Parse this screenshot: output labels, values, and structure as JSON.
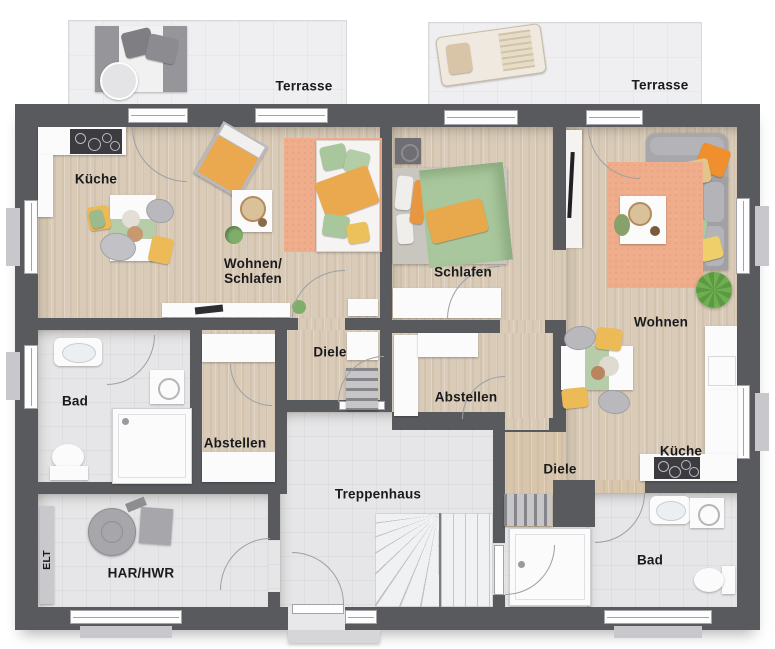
{
  "floorplan": {
    "type": "apartment-floor-plan",
    "rooms": {
      "terrace_left": {
        "label": "Terrasse"
      },
      "terrace_right": {
        "label": "Terrasse"
      },
      "kueche_left": {
        "label": "Küche"
      },
      "wohnen_schlafen": {
        "label_line1": "Wohnen/",
        "label_line2": "Schlafen"
      },
      "schlafen_right": {
        "label": "Schlafen"
      },
      "wohnen_right": {
        "label": "Wohnen"
      },
      "diele_left": {
        "label": "Diele"
      },
      "bad_left": {
        "label": "Bad"
      },
      "abstellen_right": {
        "label": "Abstellen"
      },
      "abstellen_left": {
        "label": "Abstellen"
      },
      "kueche_right": {
        "label": "Küche"
      },
      "diele_right": {
        "label": "Diele"
      },
      "treppenhaus": {
        "label": "Treppenhaus"
      },
      "har_hwr": {
        "label": "HAR/HWR"
      },
      "elt": {
        "label": "ELT"
      },
      "bad_right": {
        "label": "Bad"
      }
    },
    "colors": {
      "wall": "#595a5e",
      "wood_floor": "#d9cbb8",
      "tile_floor": "#e6e6e8",
      "terrace_floor": "#efeff1",
      "rug_peach": "#efad8b",
      "textile_green": "#a9c79c",
      "textile_orange": "#e8a84c",
      "textile_yellow": "#ecc05a",
      "sofa_gray": "#a8a8ac",
      "label_text": "#1a1a1d"
    }
  }
}
